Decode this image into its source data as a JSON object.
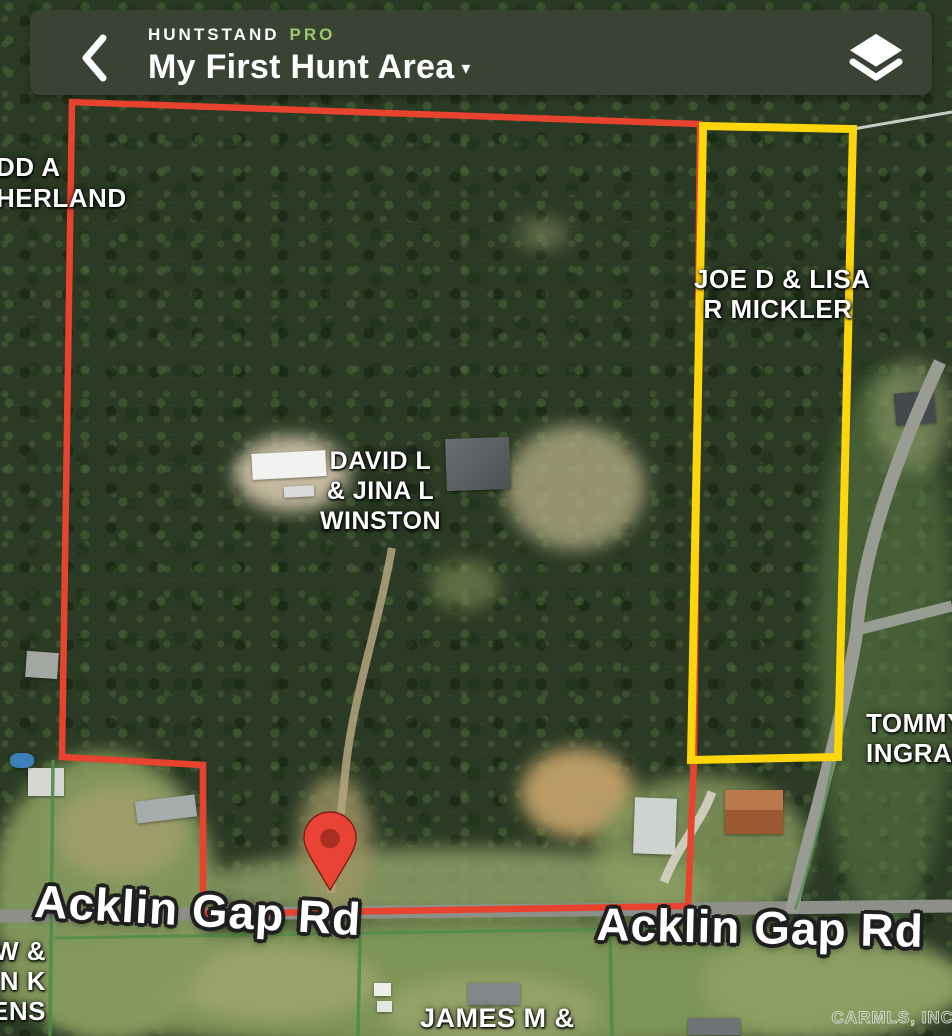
{
  "header": {
    "brand": "HUNTSTAND",
    "brand_pro": "PRO",
    "title": "My First Hunt Area",
    "caret": "▾"
  },
  "map": {
    "watermark": "CARMLS, INC",
    "colors": {
      "hunt_area_boundary": "#e8432e",
      "selected_parcel_boundary": "#ffd60a",
      "parcel_line_green": "#4e8c49",
      "parcel_line_light": "#dfe7e2",
      "pin": "#ea4335",
      "pin_inner": "#a82f21",
      "header_bar": "#3a4234",
      "pro_green": "#9fc76c"
    },
    "parcels": [
      {
        "name": "sutherland",
        "lines": [
          "DD A",
          "HERLAND"
        ]
      },
      {
        "name": "mickler",
        "lines": [
          "JOE D & LISA",
          "R MICKLER"
        ]
      },
      {
        "name": "winston",
        "lines": [
          "DAVID L",
          "& JINA L",
          "WINSTON"
        ]
      },
      {
        "name": "ingram",
        "lines": [
          "TOMMY",
          "INGRAM"
        ]
      },
      {
        "name": "neighbor-sw",
        "lines": [
          "W &",
          "EN K",
          "ENS"
        ]
      },
      {
        "name": "james",
        "lines": [
          "JAMES M &"
        ]
      }
    ],
    "road_labels": [
      {
        "name": "acklin-gap-west",
        "text": "Acklin Gap Rd"
      },
      {
        "name": "acklin-gap-east",
        "text": "Acklin Gap Rd"
      }
    ]
  }
}
